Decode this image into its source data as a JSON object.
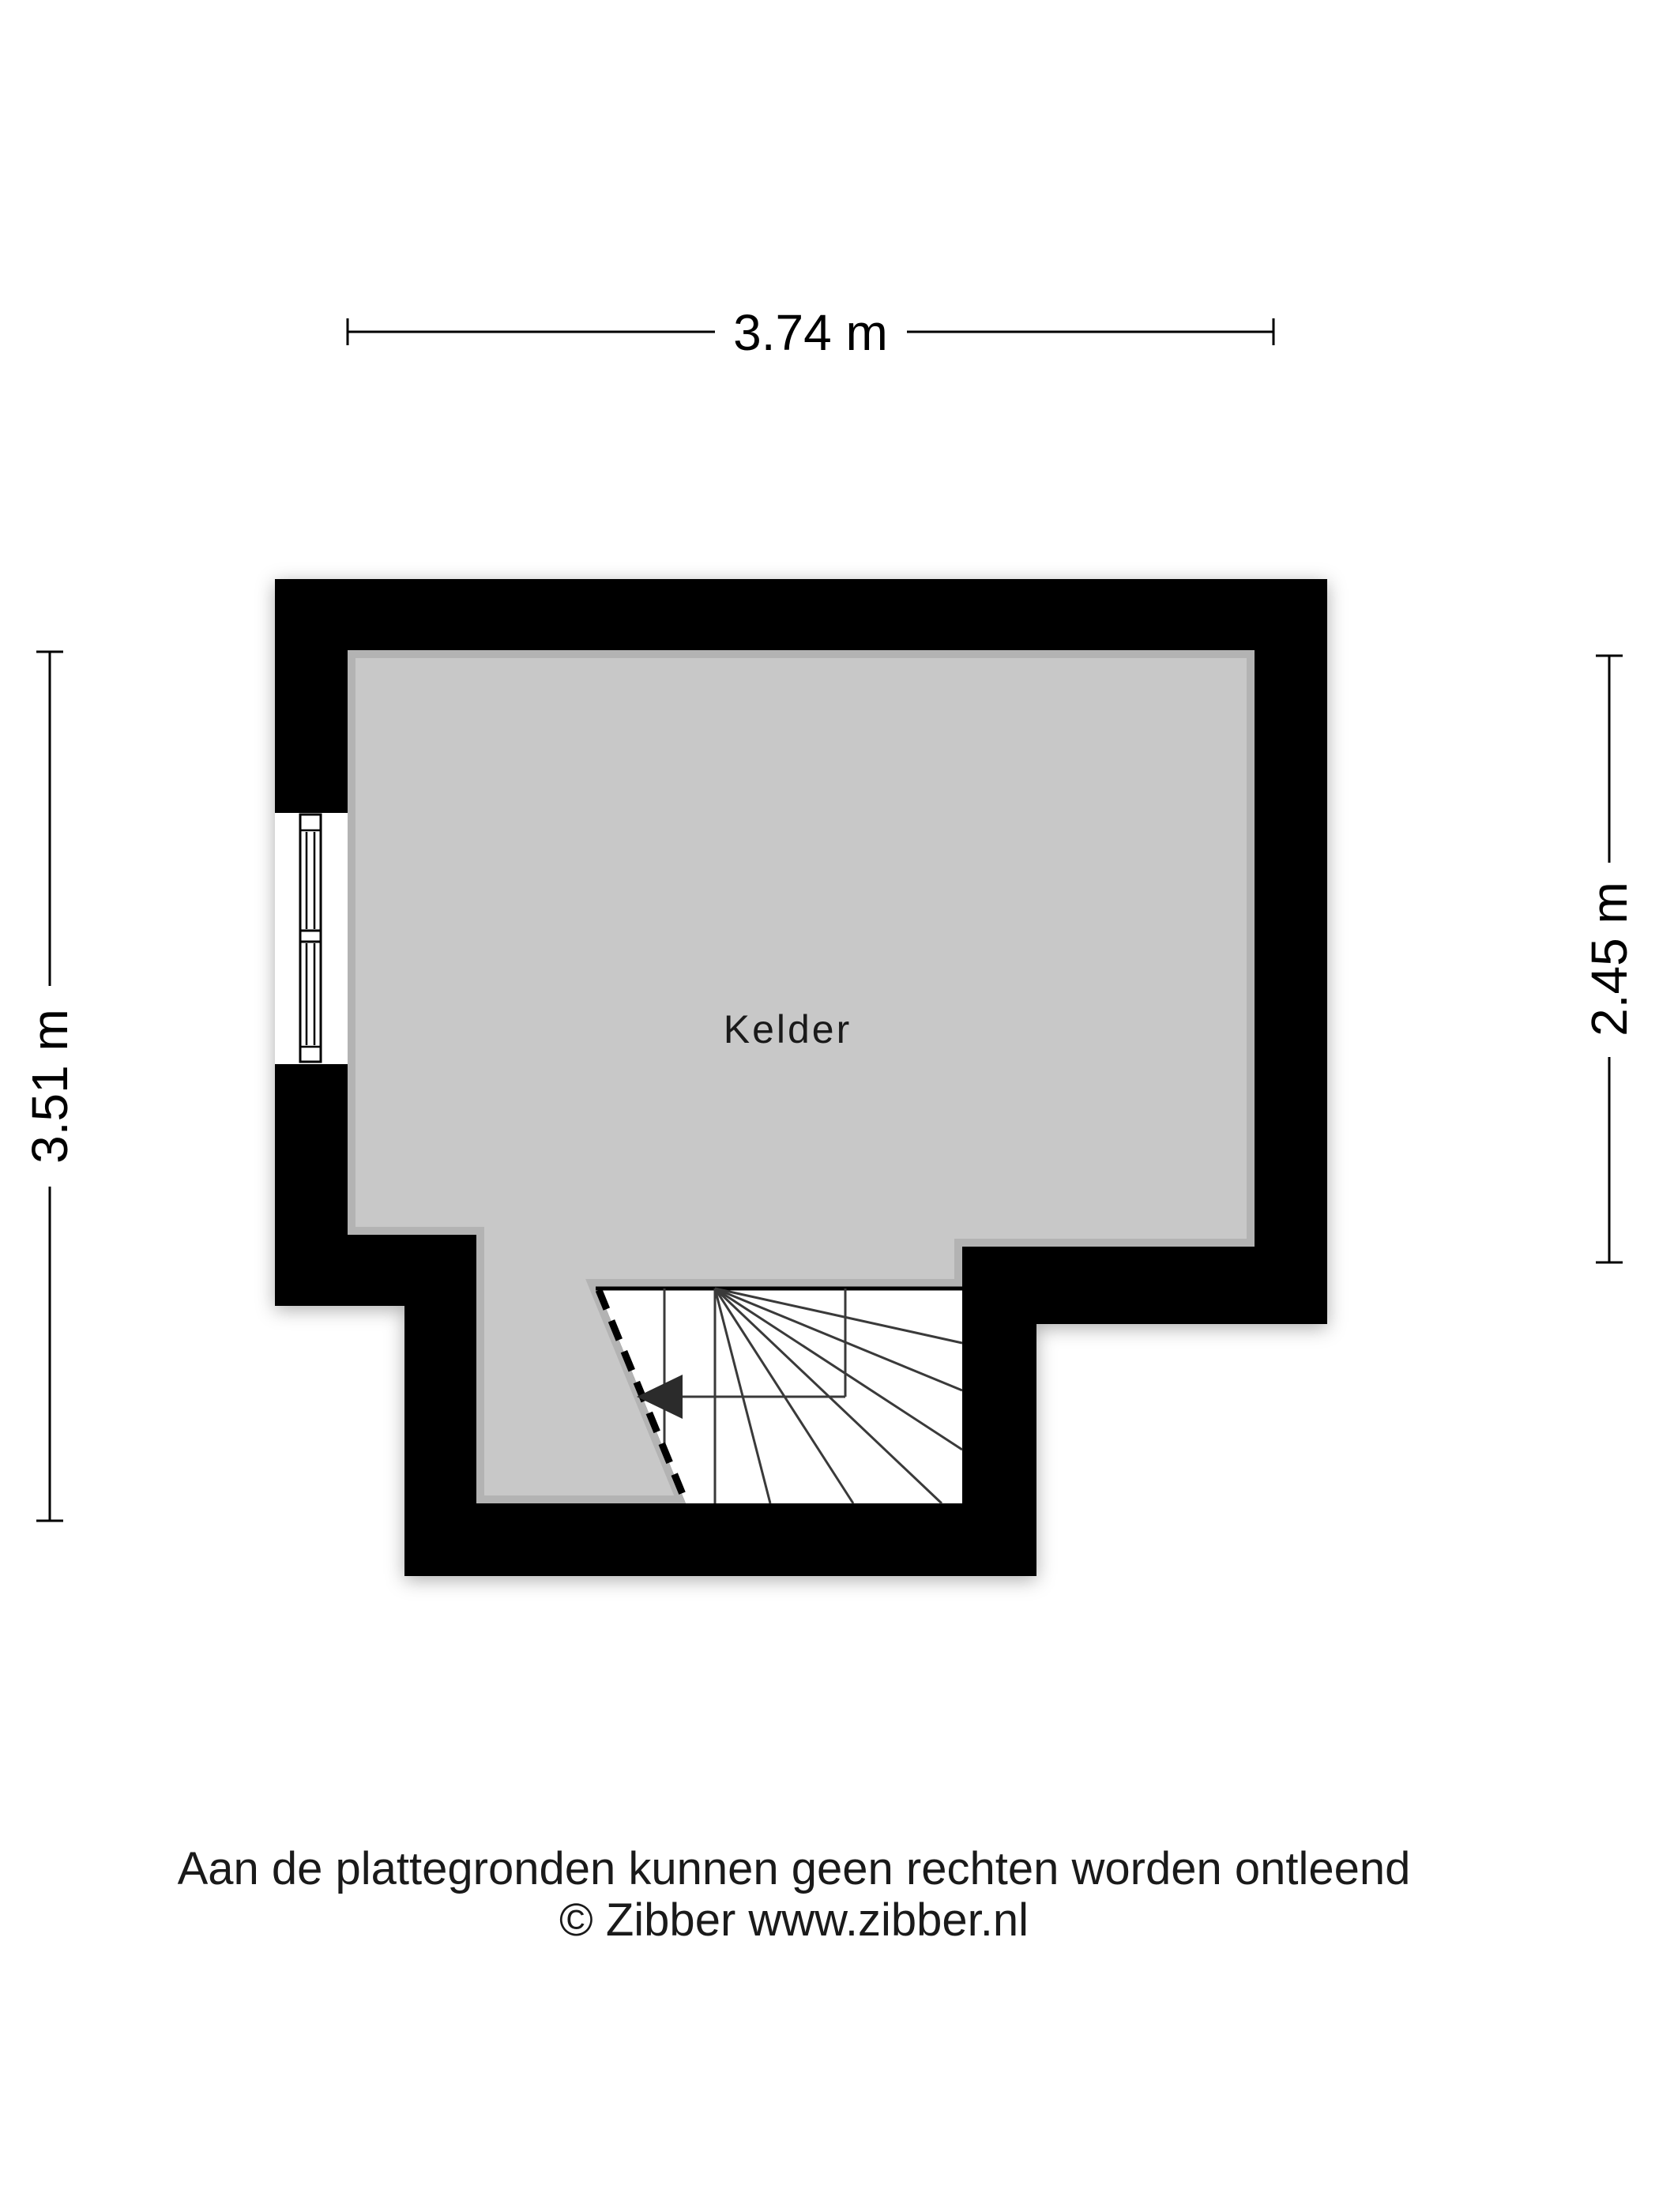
{
  "floorplan": {
    "room_label": "Kelder",
    "dimensions": {
      "width_top": "3.74 m",
      "height_left": "3.51 m",
      "height_right": "2.45 m"
    }
  },
  "footer": {
    "disclaimer": "Aan de plattegronden kunnen geen rechten worden ontleend",
    "copyright": "© Zibber www.zibber.nl"
  },
  "colors": {
    "wall": "#000000",
    "floor": "#c8c8c8",
    "stair_line": "#3a3a3a",
    "arrow": "#2b2b2b",
    "dimension_line": "#000000",
    "background": "#ffffff",
    "text": "#1a1a1a"
  }
}
